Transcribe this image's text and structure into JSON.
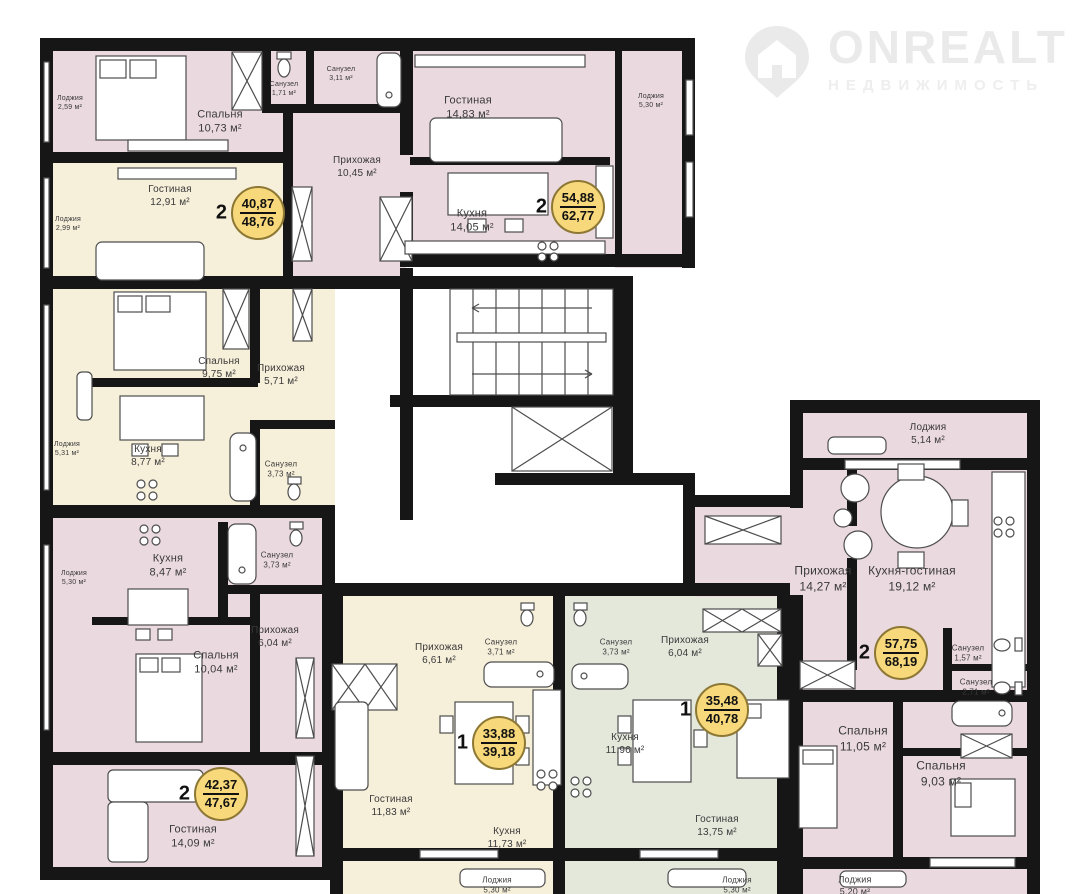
{
  "brand": {
    "name": "ONREALT",
    "subtitle": "НЕДВИЖИМОСТЬ"
  },
  "units": [
    {
      "rooms": "2",
      "living_area": "40,87",
      "total_area": "48,76"
    },
    {
      "rooms": "2",
      "living_area": "54,88",
      "total_area": "62,77"
    },
    {
      "rooms": "2",
      "living_area": "42,37",
      "total_area": "47,67"
    },
    {
      "rooms": "1",
      "living_area": "33,88",
      "total_area": "39,18"
    },
    {
      "rooms": "1",
      "living_area": "35,48",
      "total_area": "40,78"
    },
    {
      "rooms": "2",
      "living_area": "57,75",
      "total_area": "68,19"
    }
  ],
  "rooms": [
    {
      "name": "Лоджия",
      "area": "2,59 м²"
    },
    {
      "name": "Спальня",
      "area": "10,73 м²"
    },
    {
      "name": "Санузел",
      "area": "1,71 м²"
    },
    {
      "name": "Санузел",
      "area": "3,11 м²"
    },
    {
      "name": "Прихожая",
      "area": "10,45 м²"
    },
    {
      "name": "Гостиная",
      "area": "14,83 м²"
    },
    {
      "name": "Кухня",
      "area": "14,05 м²"
    },
    {
      "name": "Лоджия",
      "area": "5,30 м²"
    },
    {
      "name": "Гостиная",
      "area": "12,91 м²"
    },
    {
      "name": "Лоджия",
      "area": "2,99 м²"
    },
    {
      "name": "Спальня",
      "area": "9,75 м²"
    },
    {
      "name": "Прихожая",
      "area": "5,71 м²"
    },
    {
      "name": "Кухня",
      "area": "8,77 м²"
    },
    {
      "name": "Лоджия",
      "area": "5,31 м²"
    },
    {
      "name": "Санузел",
      "area": "3,73 м²"
    },
    {
      "name": "Кухня",
      "area": "8,47 м²"
    },
    {
      "name": "Санузел",
      "area": "3,73 м²"
    },
    {
      "name": "Лоджия",
      "area": "5,30 м²"
    },
    {
      "name": "Прихожая",
      "area": "6,04 м²"
    },
    {
      "name": "Спальня",
      "area": "10,04 м²"
    },
    {
      "name": "Гостиная",
      "area": "14,09 м²"
    },
    {
      "name": "Прихожая",
      "area": "6,61 м²"
    },
    {
      "name": "Санузел",
      "area": "3,71 м²"
    },
    {
      "name": "Гостиная",
      "area": "11,83 м²"
    },
    {
      "name": "Кухня",
      "area": "11,73 м²"
    },
    {
      "name": "Лоджия",
      "area": "5,30 м²"
    },
    {
      "name": "Санузел",
      "area": "3,73 м²"
    },
    {
      "name": "Прихожая",
      "area": "6,04 м²"
    },
    {
      "name": "Кухня",
      "area": "11,96 м²"
    },
    {
      "name": "Гостиная",
      "area": "13,75 м²"
    },
    {
      "name": "Лоджия",
      "area": "5,30 м²"
    },
    {
      "name": "Лоджия",
      "area": "5,14 м²"
    },
    {
      "name": "Прихожая",
      "area": "14,27 м²"
    },
    {
      "name": "Кухня-гостиная",
      "area": "19,12 м²"
    },
    {
      "name": "Санузел",
      "area": "1,57 м²"
    },
    {
      "name": "Санузел",
      "area": "2,71 м²"
    },
    {
      "name": "Спальня",
      "area": "11,05 м²"
    },
    {
      "name": "Спальня",
      "area": "9,03 м²"
    },
    {
      "name": "Лоджия",
      "area": "5,20 м²"
    }
  ],
  "colors": {
    "apartment_pink": "#ead9df",
    "apartment_cream": "#f6efda",
    "apartment_green": "#e4e8db",
    "wall": "#161616",
    "badge_fill": "#f7d87b",
    "badge_border": "#8d7734",
    "logo_gray": "#eaeaea"
  }
}
